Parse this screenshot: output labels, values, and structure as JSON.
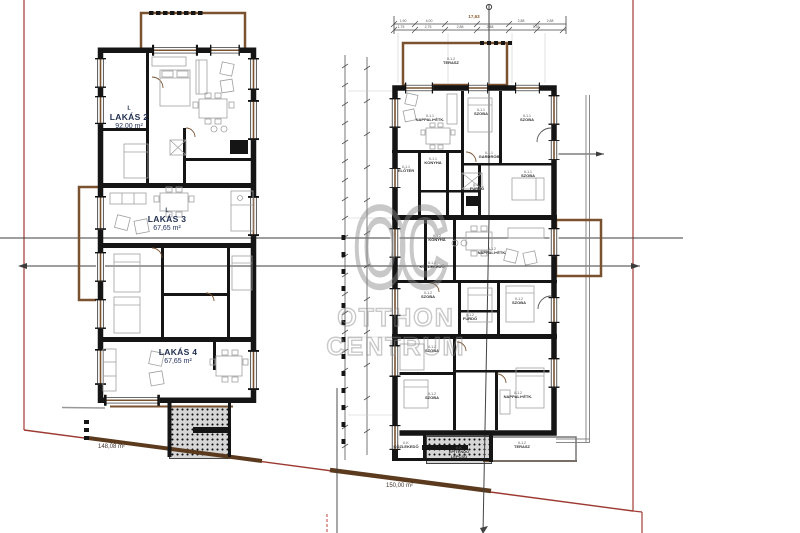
{
  "watermark": {
    "logo": "OC",
    "name_top": "OTTHON",
    "name_bottom": "CENTRUM"
  },
  "left_building": {
    "units": [
      {
        "floor": "I.",
        "name": "LAKÁS 2",
        "area": "92,00 m²"
      },
      {
        "floor": "I.",
        "name": "LAKÁS 3",
        "area": "67,65 m²"
      },
      {
        "floor": "",
        "name": "LAKÁS 4",
        "area": "67,65 m²"
      }
    ]
  },
  "right_building": {
    "rooms": [
      {
        "code": "II-1.1",
        "name": "NAPPALI+ÉTK."
      },
      {
        "code": "II-1.1",
        "name": "SZOBA"
      },
      {
        "code": "II-1.1",
        "name": "SZOBA"
      },
      {
        "code": "II-1.1",
        "name": "ELŐTÉR"
      },
      {
        "code": "II-1.1",
        "name": "KONYHA"
      },
      {
        "code": "II-1.1",
        "name": "GARDRÓB"
      },
      {
        "code": "II-1.1",
        "name": "FÜRDŐ"
      },
      {
        "code": "II-1.1",
        "name": "SZOBA"
      },
      {
        "code": "II-1.2",
        "name": "KONYHA"
      },
      {
        "code": "II-1.2",
        "name": "NAPPALI+ÉTK."
      },
      {
        "code": "II-1.2",
        "name": "KÖZLEKEDŐ"
      },
      {
        "code": "II-1.2",
        "name": "SZOBA"
      },
      {
        "code": "II-1.2",
        "name": "FÜRDŐ"
      },
      {
        "code": "II-1.2",
        "name": "SZOBA"
      },
      {
        "code": "II-1.2",
        "name": "SZOBA"
      },
      {
        "code": "II-1.2",
        "name": "SZOBA"
      },
      {
        "code": "II-1.2",
        "name": "NAPPALI+ÉTK."
      },
      {
        "code": "II-K",
        "name": "KÖZLEKEDŐ"
      },
      {
        "code": "II-K",
        "name": "ÉPÍTENDŐ LÉPCSŐ"
      },
      {
        "code": "II-1.2",
        "name": "TERASZ"
      },
      {
        "code": "II-1.2",
        "name": "TERASZ"
      }
    ]
  },
  "site": {
    "left_parcel_area": "148,08 m²",
    "right_parcel_area": "150,00 m²"
  },
  "dimensions": {
    "total_width": "17,63",
    "row1": [
      "1,90",
      "4,00",
      "2,88",
      "2,88"
    ],
    "row2": [
      "1,75",
      "2,75",
      "2,88",
      "2,88",
      "1,35"
    ]
  },
  "colors": {
    "wall": "#151515",
    "terrace_brown": "#7a5230",
    "parcel_red": "#a33b35",
    "watermark_gray": "#8a8a8a",
    "unit_label_navy": "#1f2d4e"
  }
}
